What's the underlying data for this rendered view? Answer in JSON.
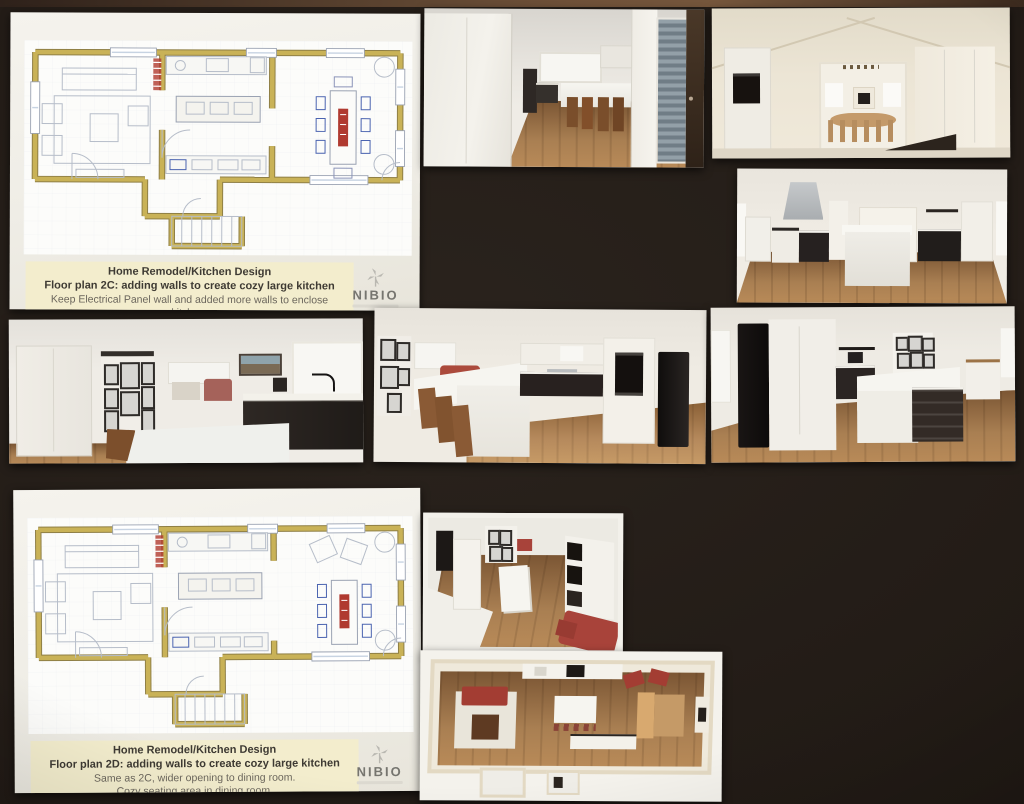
{
  "colors": {
    "board-bg": "#221b16",
    "sheet-bg": "#f2efe8",
    "caption-bg": "#f3edcd",
    "plan-wall": "#c9b257",
    "plan-furniture": "#b6bdc9",
    "accent-red": "#b03a30",
    "accent-blue": "#4a63b0",
    "dark-cabinet": "#221d1b",
    "wood-floor": "#a47a4e",
    "logo-gray": "#76756f"
  },
  "sheets": {
    "plan2c": {
      "title": "Home Remodel/Kitchen Design",
      "subtitle": "Floor plan 2C: adding walls to create cozy large kitchen",
      "line1": "Keep Electrical Panel wall and added more walls to enclose kitchen.",
      "line2": "1 large waterfall island, only one large window. At Hood roof line changes.",
      "logo": "NIBIO"
    },
    "plan2d": {
      "title": "Home Remodel/Kitchen Design",
      "subtitle": "Floor plan 2D: adding walls to create cozy large kitchen",
      "line1": "Same as 2C, wider opening to dining room.",
      "line2": "Cozy seating area in dining room.",
      "logo": "NIBIO"
    }
  }
}
